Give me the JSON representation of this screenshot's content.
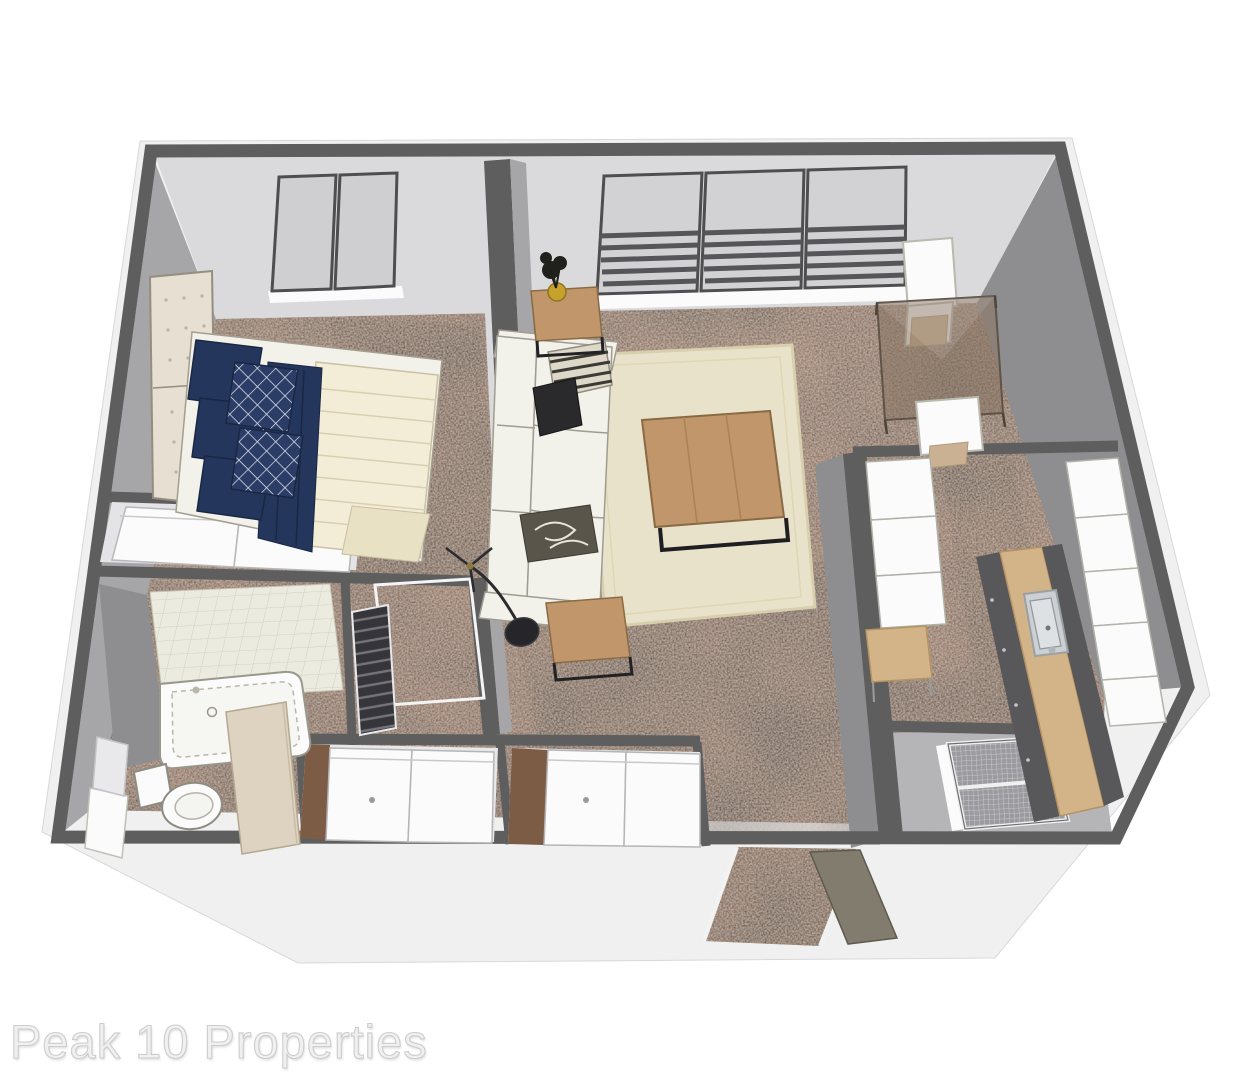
{
  "watermark": {
    "text": "Peak 10 Properties"
  },
  "scene": {
    "type": "3d-floor-plan-rendering",
    "view": "isometric dollhouse top-down",
    "rooms": [
      "bedroom",
      "living-room",
      "dining-nook",
      "kitchen",
      "bathroom",
      "walk-in-closet",
      "bedroom-closet",
      "utility-closet",
      "hall-closets",
      "entry"
    ],
    "furniture": [
      "bed",
      "tufted-headboard",
      "navy-pillows",
      "lattice-pillows",
      "navy-throw",
      "sofa",
      "throw-pillows",
      "coffee-table",
      "side-tables",
      "arc-floor-lamp",
      "plant",
      "wall-tv",
      "area-rug",
      "glass-dining-table",
      "dining-chairs",
      "kitchen-island-with-sink",
      "upper-cabinets",
      "refrigerator",
      "desk",
      "wire-shelving",
      "bathtub",
      "toilet",
      "shower-tile",
      "vanity-mirror",
      "sliding-closet-doors",
      "louvered-door",
      "entry-door",
      "windows-with-blinds"
    ]
  },
  "palette": {
    "exterior": "#f0f0f1",
    "wallTop": "#5e5e5e",
    "wallLight": "#dadadc",
    "wallMid": "#a6a6a8",
    "wallDark": "#8e8e90",
    "carpet": "#8a6852",
    "carpetDark": "#5e4030",
    "carpetLight": "#9d7d65",
    "rug": "#e9e2ca",
    "rugEdge": "#d8cfae",
    "wood": "#c0966a",
    "woodDark": "#8a6a44",
    "cream": "#f2f1ea",
    "comforter": "#f3ecd7",
    "navy": "#25365c",
    "navyDark": "#1a2744",
    "tile": "#edeadd",
    "tileLine": "#d1cebe",
    "counter": "#d3b488",
    "cabinet": "#58585a",
    "steel": "#ccd0d3",
    "glass": "#8a7563",
    "doorBeige": "#ddd3c0",
    "doorOlive": "#827c6e",
    "black": "#222225",
    "potYellow": "#c6a22c",
    "white": "#fbfbfc",
    "watermark": "#f0f0f0"
  }
}
